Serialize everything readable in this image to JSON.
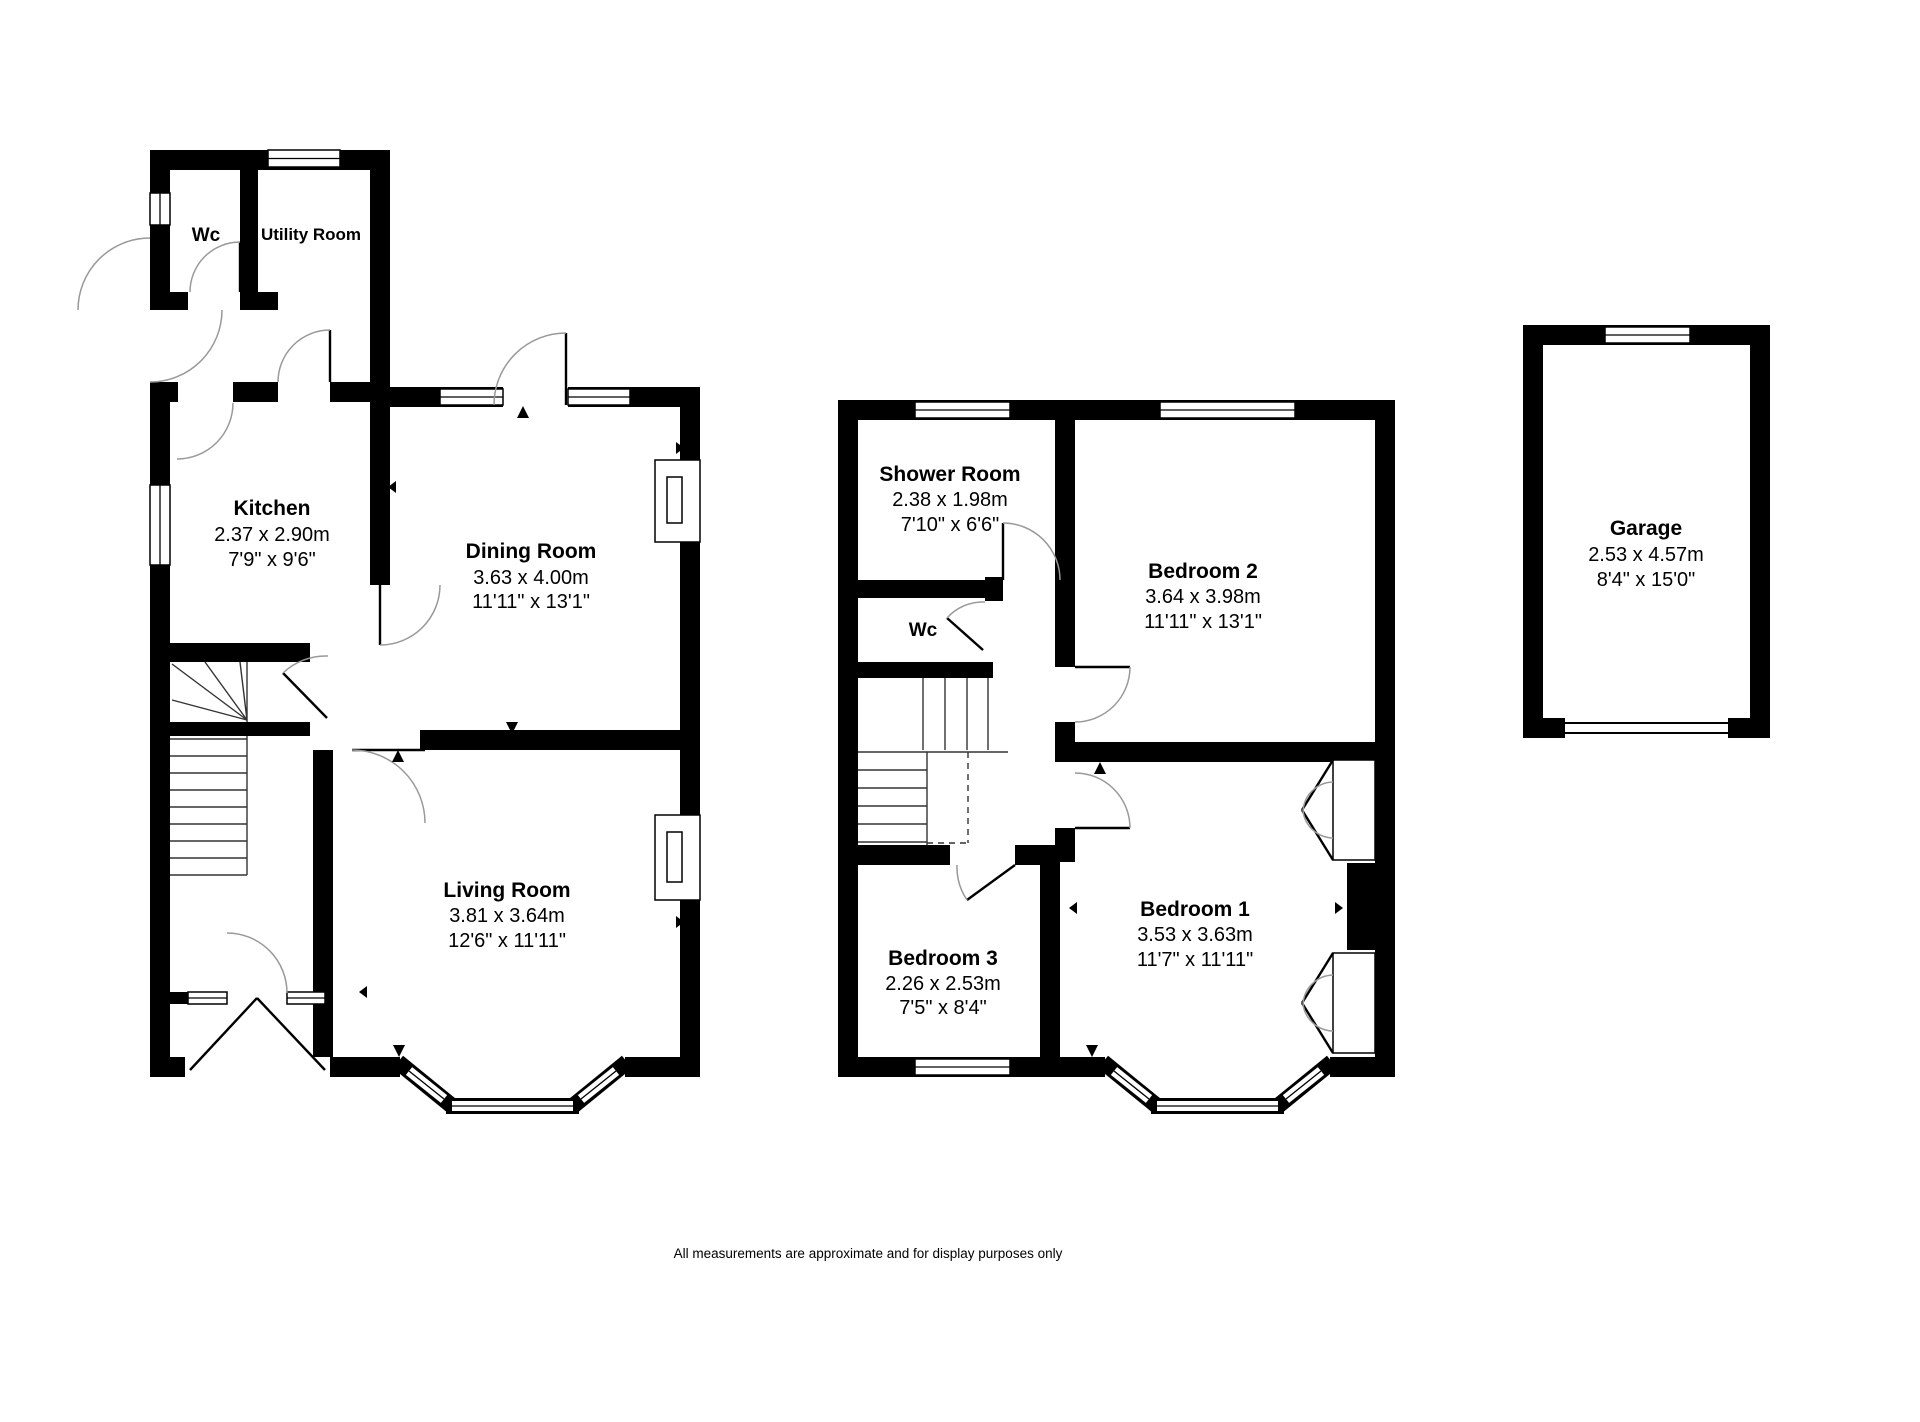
{
  "rooms": {
    "wc_ground": {
      "name": "Wc"
    },
    "utility": {
      "name": "Utility Room"
    },
    "kitchen": {
      "name": "Kitchen",
      "metric": "2.37 x 2.90m",
      "imperial": "7'9\" x 9'6\""
    },
    "dining": {
      "name": "Dining Room",
      "metric": "3.63 x 4.00m",
      "imperial": "11'11\" x 13'1\""
    },
    "living": {
      "name": "Living Room",
      "metric": "3.81 x 3.64m",
      "imperial": "12'6\" x 11'11\""
    },
    "shower": {
      "name": "Shower Room",
      "metric": "2.38 x 1.98m",
      "imperial": "7'10\" x 6'6\""
    },
    "wc_first": {
      "name": "Wc"
    },
    "bedroom2": {
      "name": "Bedroom 2",
      "metric": "3.64 x 3.98m",
      "imperial": "11'11\" x 13'1\""
    },
    "bedroom1": {
      "name": "Bedroom 1",
      "metric": "3.53 x 3.63m",
      "imperial": "11'7\" x 11'11\""
    },
    "bedroom3": {
      "name": "Bedroom 3",
      "metric": "2.26 x 2.53m",
      "imperial": "7'5\" x 8'4\""
    },
    "garage": {
      "name": "Garage",
      "metric": "2.53 x 4.57m",
      "imperial": "8'4\" x 15'0\""
    }
  },
  "footer": {
    "disclaimer": "All measurements are approximate and for display purposes only"
  },
  "colors": {
    "wall": "#000000",
    "background": "#ffffff",
    "door_arc": "#999999",
    "text": "#000000"
  }
}
